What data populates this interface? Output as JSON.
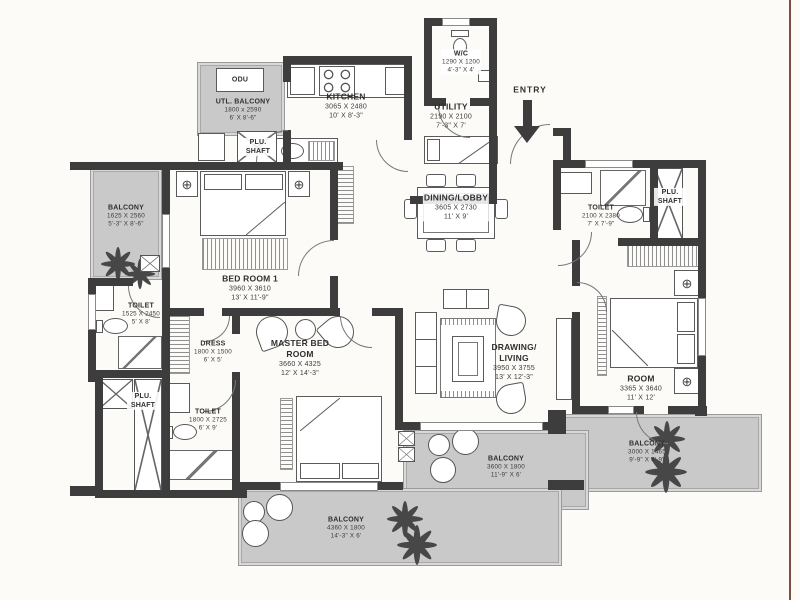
{
  "colors": {
    "wall": "#3d3d3d",
    "balcony_floor": "#c9c9c9",
    "frame_line": "#7a4e40",
    "text": "#2f2f2f"
  },
  "icons": {
    "lamp": "⊕"
  },
  "misc": {
    "entry": "ENTRY",
    "odu": "ODU",
    "plu_shaft": "PLU. SHAFT"
  },
  "rooms": [
    {
      "name": "UTL. BALCONY",
      "dim_mm": "1800 x 2590",
      "dim_ft": "6' X 8'-6\""
    },
    {
      "name": "KITCHEN",
      "dim_mm": "3065 X 2480",
      "dim_ft": "10' X 8'-3\""
    },
    {
      "name": "W/C",
      "dim_mm": "1290 X 1200",
      "dim_ft": "4'-3\" X 4'"
    },
    {
      "name": "UTILITY",
      "dim_mm": "2190 X 2100",
      "dim_ft": "7'-3\" X 7'"
    },
    {
      "name": "DINING/LOBBY",
      "dim_mm": "3605 X 2730",
      "dim_ft": "11' X 9'"
    },
    {
      "name": "BALCONY",
      "dim_mm": "1625 X 2560",
      "dim_ft": "5'-3\" X 8'-6\""
    },
    {
      "name": "BED ROOM 1",
      "dim_mm": "3960 X 3610",
      "dim_ft": "13' X 11'-9\""
    },
    {
      "name": "TOILET",
      "dim_mm": "1525 X 2450",
      "dim_ft": "5' X 8'"
    },
    {
      "name": "DRESS",
      "dim_mm": "1800 X 1500",
      "dim_ft": "6' X 5'"
    },
    {
      "name": "MASTER BED ROOM",
      "dim_mm": "3660 X 4325",
      "dim_ft": "12' X 14'-3\""
    },
    {
      "name": "TOILET",
      "dim_mm": "1800 X 2725",
      "dim_ft": "6' X 9'"
    },
    {
      "name": "DRAWING/ LIVING",
      "dim_mm": "3950 X 3755",
      "dim_ft": "13' X 12'-3\""
    },
    {
      "name": "TOILET",
      "dim_mm": "2100 X 2380",
      "dim_ft": "7' X 7'-9\""
    },
    {
      "name": "ROOM",
      "dim_mm": "3365 X 3640",
      "dim_ft": "11' X 12'"
    },
    {
      "name": "BALCONY",
      "dim_mm": "3000 X 1465",
      "dim_ft": "9'-9\" X 4'-9\""
    },
    {
      "name": "BALCONY",
      "dim_mm": "3600 X 1800",
      "dim_ft": "11'-9\" X 6'"
    },
    {
      "name": "BALCONY",
      "dim_mm": "4360 X 1800",
      "dim_ft": "14'-3\" X 6'"
    }
  ]
}
